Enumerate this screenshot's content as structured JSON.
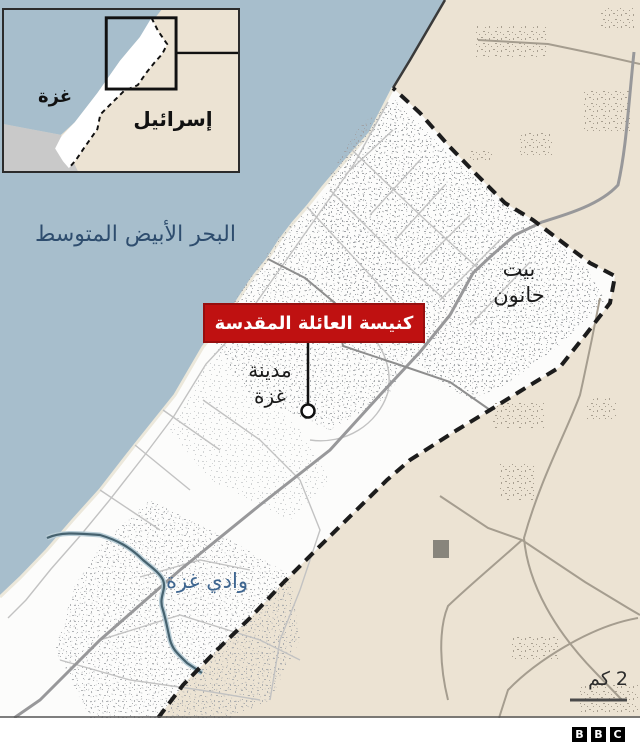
{
  "inset": {
    "gaza": "غزة",
    "israel": "إسرائيل"
  },
  "labels": {
    "sea": "البحر الأبيض المتوسط",
    "beit_hanoun_line1": "بيت",
    "beit_hanoun_line2": "حانون",
    "church": "كنيسة العائلة المقدسة",
    "gaza_city_line1": "مدينة",
    "gaza_city_line2": "غزة",
    "wadi": "وادي غزة",
    "scale": "2 كم"
  },
  "branding": {
    "letters": [
      "B",
      "B",
      "C"
    ]
  },
  "colors": {
    "sea": "#a7becc",
    "israel_land": "#ece3d3",
    "gaza_land": "#fcfcfb",
    "egypt_gray": "#c9c9c9",
    "border_dashed": "#1c1c1c",
    "label_red": "#bf1111",
    "sea_text": "#2e4d6e",
    "wadi_text": "#3f6690",
    "wadi_stroke": "#46626f"
  }
}
